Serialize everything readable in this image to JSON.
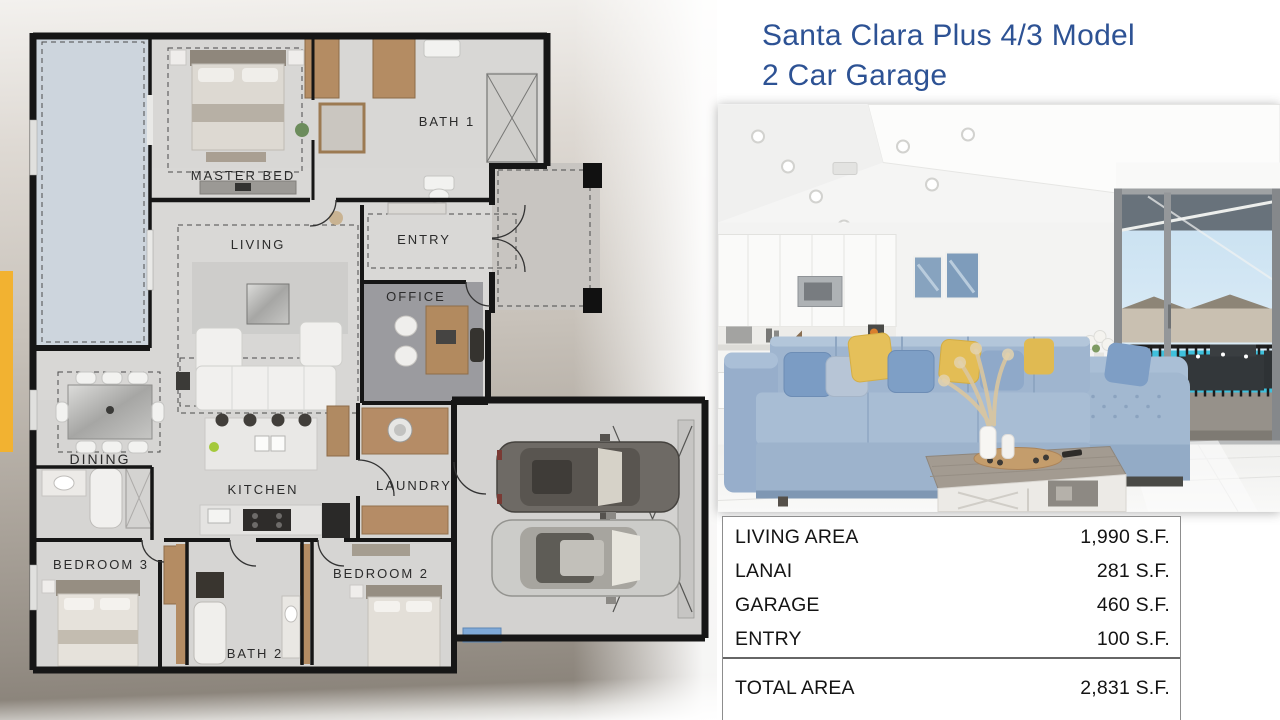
{
  "slide": {
    "title": {
      "line1": "Santa Clara Plus 4/3 Model",
      "line2": "2 Car Garage",
      "color": "#2d5294"
    }
  },
  "floor_plan": {
    "accent_yellow": "#f2b231",
    "lanai_blue": "#cdd5dd",
    "rooms": {
      "master_bed": "MASTER BED",
      "bath_1": "BATH 1",
      "entry": "ENTRY",
      "office": "OFFICE",
      "living": "LIVING",
      "dining": "DINING",
      "kitchen": "KITCHEN",
      "laundry": "LAUNDRY",
      "bedroom_3": "BEDROOM 3",
      "bath_2": "BATH 2",
      "bedroom_2": "BEDROOM 2"
    }
  },
  "photo": {
    "pool_blue": "#3fc0dc",
    "sofa_blue": "#9fb5cf",
    "pillow_yellow": "#e5c05a"
  },
  "area_table": {
    "rows": [
      {
        "label": "LIVING AREA",
        "value": "1,990 S.F."
      },
      {
        "label": "LANAI",
        "value": "281 S.F."
      },
      {
        "label": "GARAGE",
        "value": "460 S.F."
      },
      {
        "label": "ENTRY",
        "value": "100 S.F."
      }
    ],
    "total": {
      "label": "TOTAL AREA",
      "value": "2,831 S.F."
    }
  }
}
